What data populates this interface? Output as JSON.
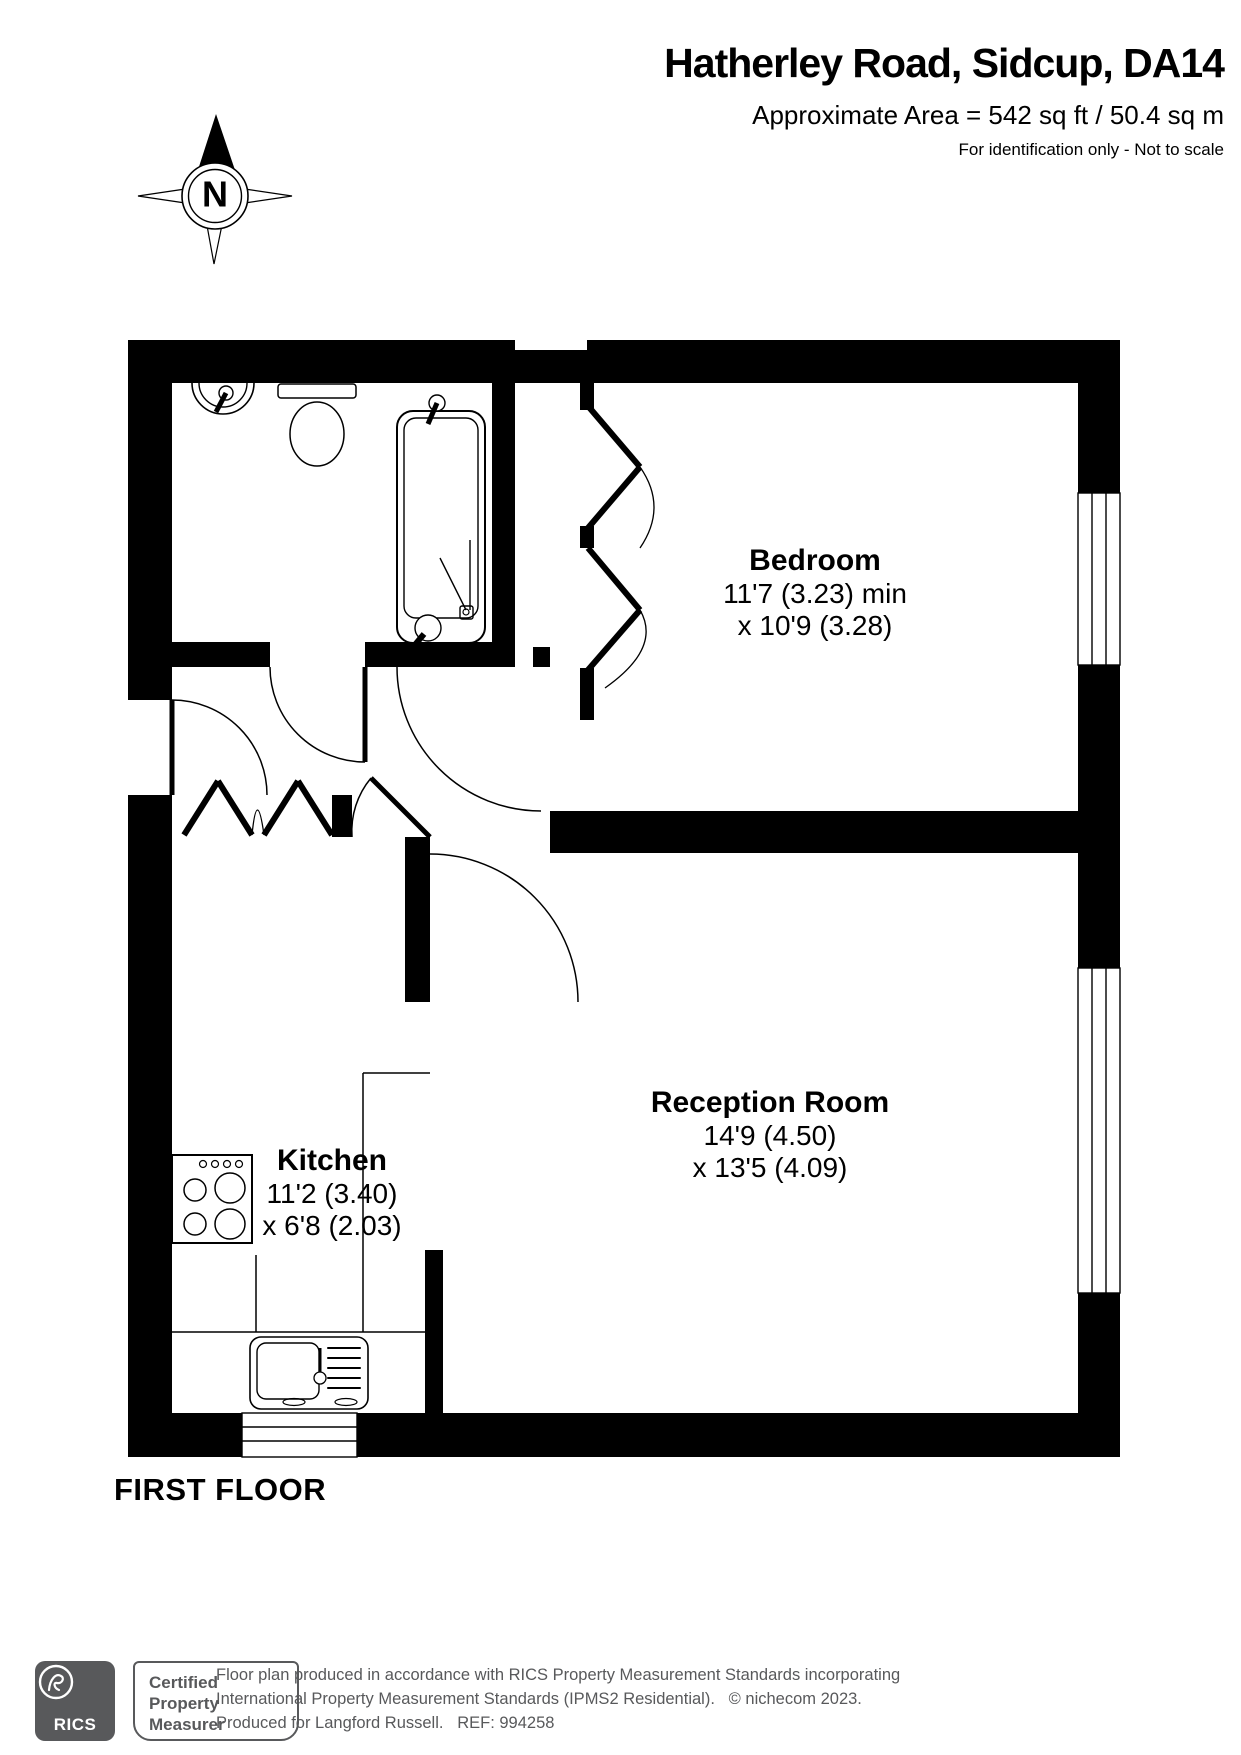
{
  "header": {
    "title": "Hatherley Road, Sidcup, DA14",
    "area_line": "Approximate Area = 542 sq ft / 50.4 sq m",
    "note": "For identification only - Not to scale"
  },
  "compass": {
    "label": "N"
  },
  "rooms": [
    {
      "name": "Bedroom",
      "dim1": "11'7 (3.23) min",
      "dim2": "x 10'9 (3.28)"
    },
    {
      "name": "Reception Room",
      "dim1": "14'9 (4.50)",
      "dim2": "x 13'5 (4.09)"
    },
    {
      "name": "Kitchen",
      "dim1": "11'2 (3.40)",
      "dim2": "x 6'8 (2.03)"
    }
  ],
  "floor": {
    "label": "FIRST FLOOR"
  },
  "footer": {
    "rics_label": "RICS",
    "badge_lines": [
      "Certified",
      "Property",
      "Measurer"
    ],
    "disclaimer": [
      "Floor plan produced in accordance with RICS Property Measurement Standards incorporating",
      "International Property Measurement Standards (IPMS2 Residential).   © nichecom 2023.",
      "Produced for Langford Russell.   REF: 994258"
    ]
  },
  "colors": {
    "wall": "#000000",
    "footer_gray": "#58595b"
  }
}
